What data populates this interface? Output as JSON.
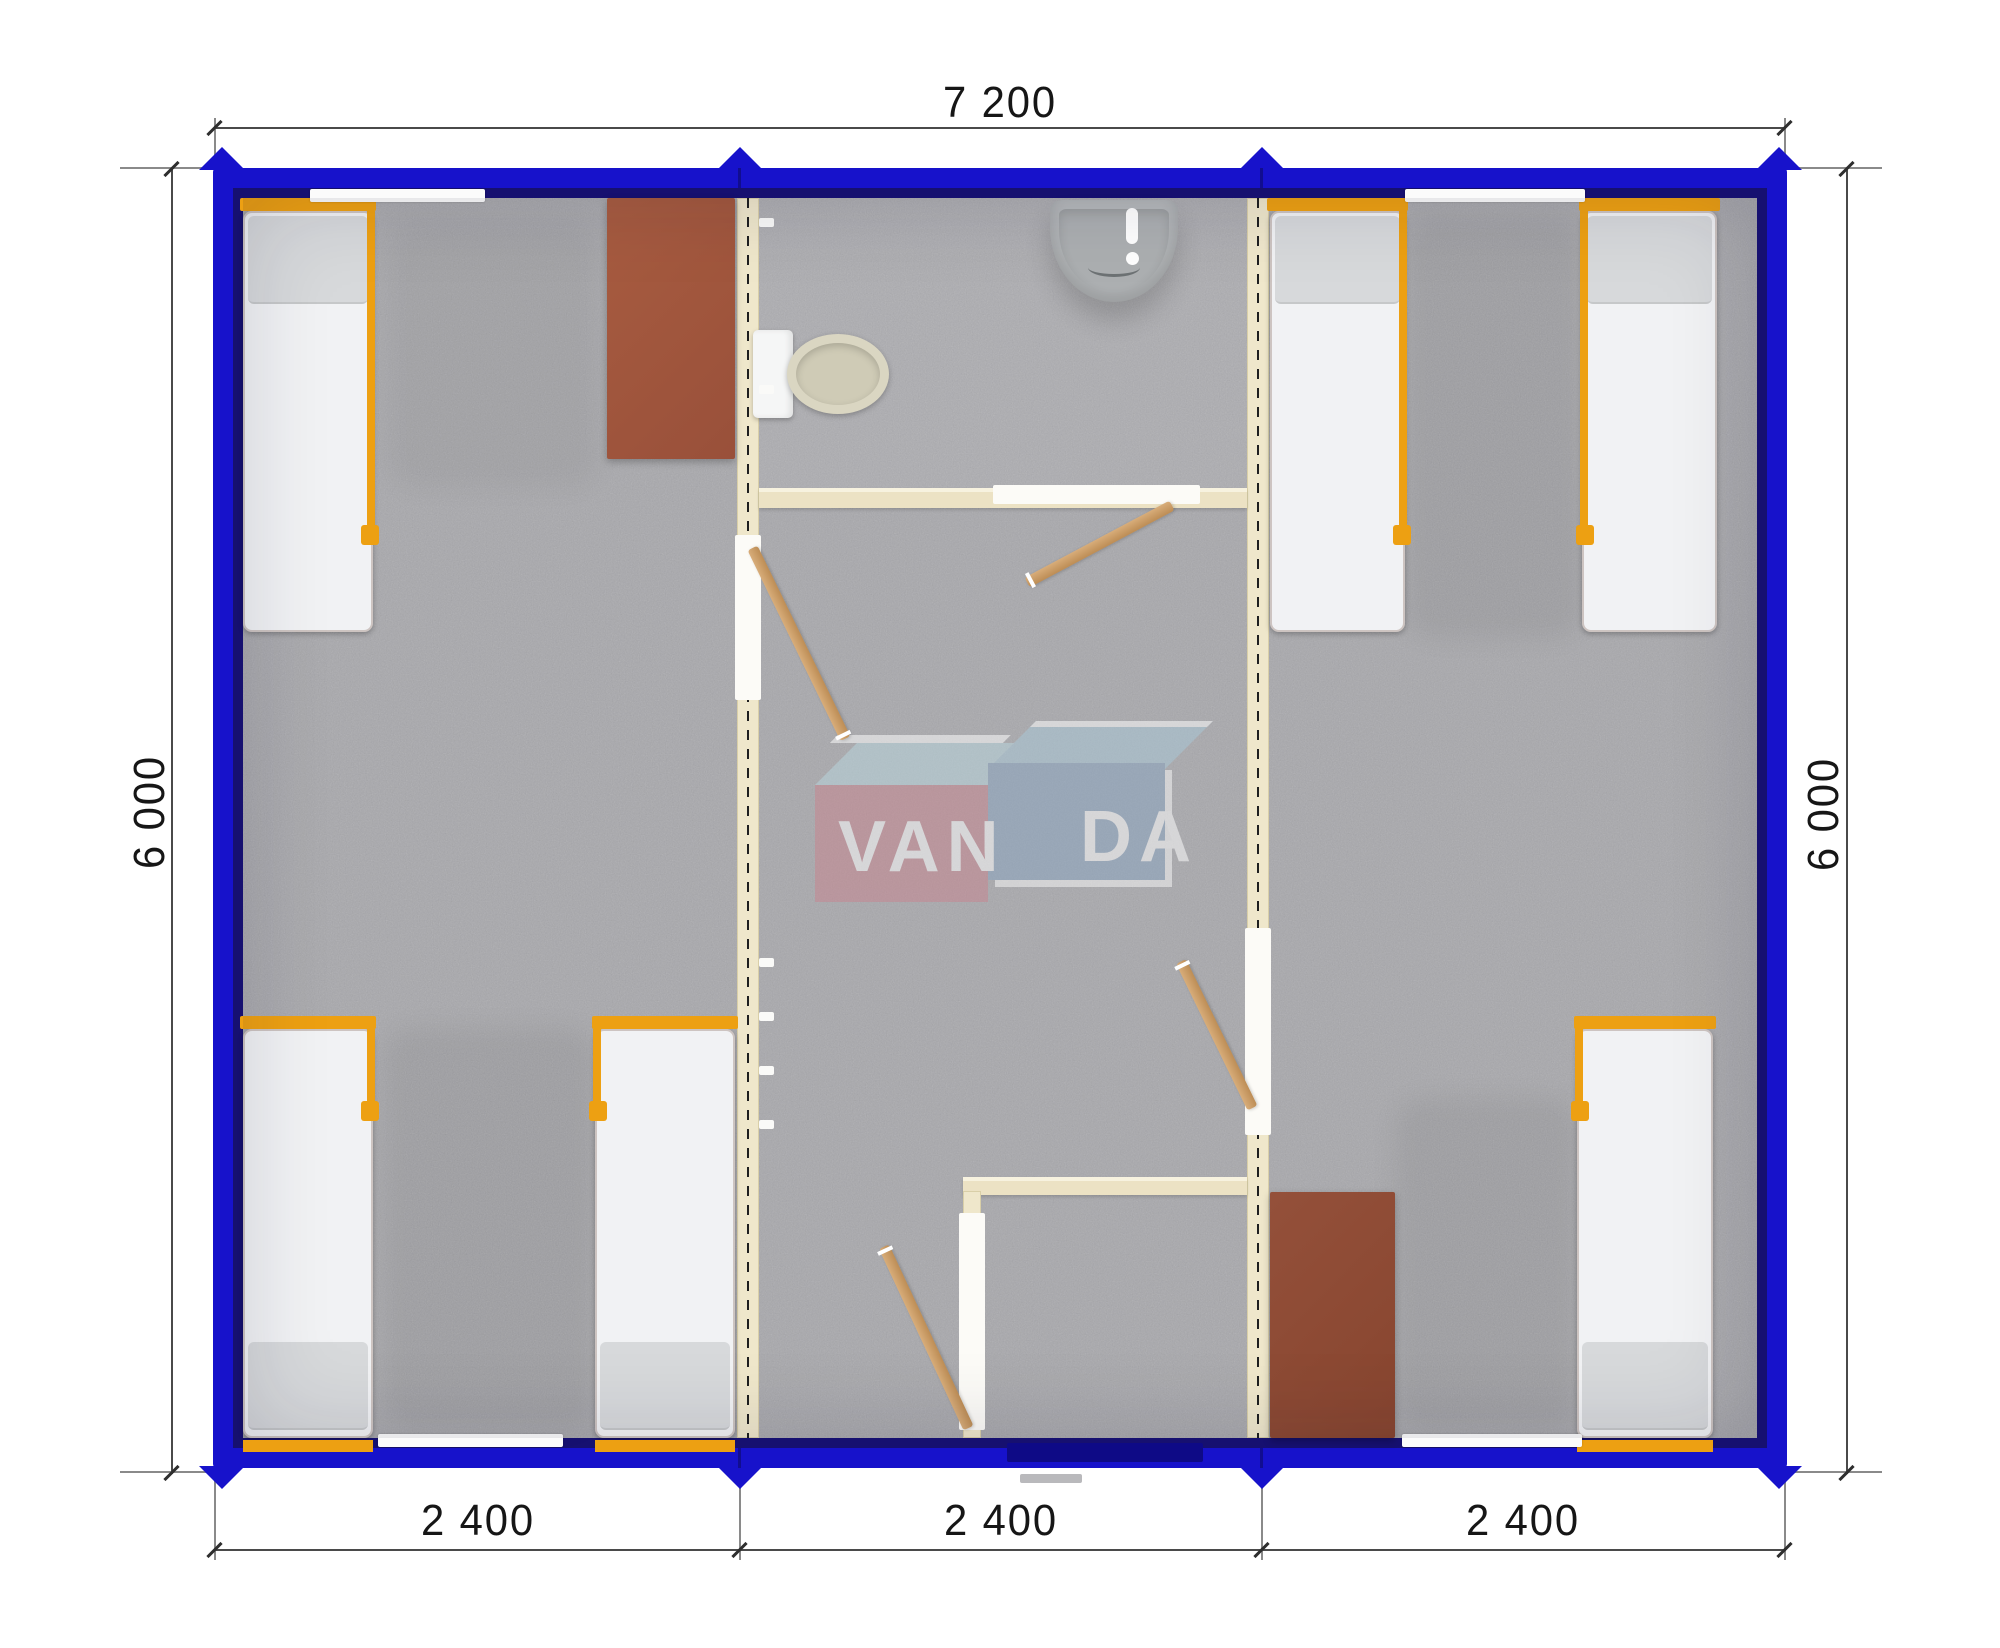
{
  "document": {
    "type": "modular building floor plan, top-down 3D render"
  },
  "dimensions": {
    "top": "7 200",
    "left": "6 000",
    "right": "6 000",
    "bottom": [
      "2 400",
      "2 400",
      "2 400"
    ]
  },
  "watermark": {
    "text": "VANDA",
    "part1": "VAN",
    "part2": "DA"
  },
  "colors": {
    "frame_blue": "#1712cb",
    "frame_inner": "#161070",
    "floor_gray": "#a8a8ac",
    "wall_cream": "#efe7cb",
    "accent_orange": "#eda012",
    "desk_brown": "#a3573b",
    "door_wood": "#c89a62",
    "logo_red": "#c8858f",
    "logo_blue": "#8aa5c1"
  },
  "fixtures": {
    "beds": 6,
    "desks": 2,
    "toilets": 1,
    "sinks": 1,
    "interior_doors": 4,
    "entrance_doors": 1,
    "windows": 4
  }
}
